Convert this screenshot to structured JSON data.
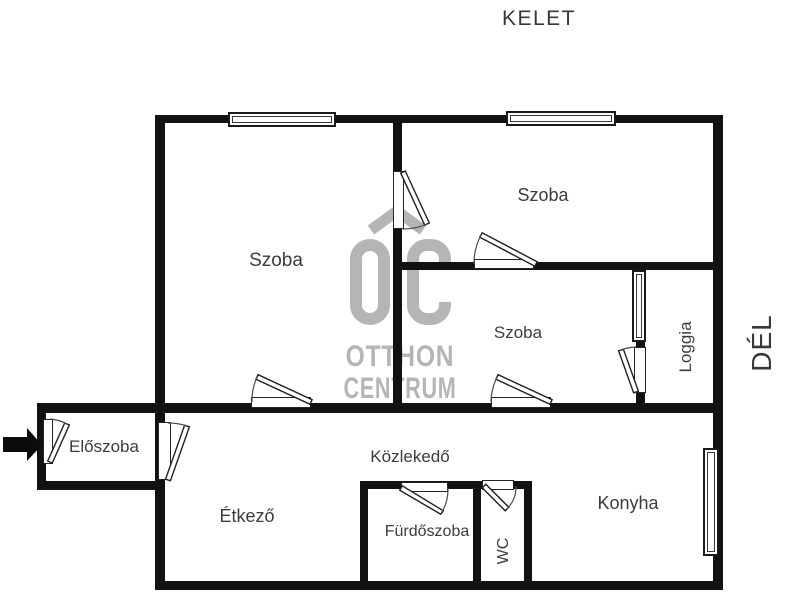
{
  "compass": {
    "east": "KELET",
    "south": "DÉL"
  },
  "watermark": {
    "line1": "OTTHON",
    "line2": "CENTRUM"
  },
  "rooms": [
    {
      "id": "szoba-left",
      "label": "Szoba"
    },
    {
      "id": "szoba-top",
      "label": "Szoba"
    },
    {
      "id": "szoba-middle",
      "label": "Szoba"
    },
    {
      "id": "loggia",
      "label": "Loggia"
    },
    {
      "id": "eloszoba",
      "label": "Előszoba"
    },
    {
      "id": "etkezo",
      "label": "Étkező"
    },
    {
      "id": "kozlekedo",
      "label": "Közlekedő"
    },
    {
      "id": "furdoszoba",
      "label": "Fürdőszoba"
    },
    {
      "id": "wc",
      "label": "WC"
    },
    {
      "id": "konyha",
      "label": "Konyha"
    }
  ],
  "colors": {
    "wall": "#121212",
    "label": "#3c3c3c",
    "watermark": "#b5b5b5",
    "swing": "#4a4a4a",
    "background": "#ffffff"
  }
}
